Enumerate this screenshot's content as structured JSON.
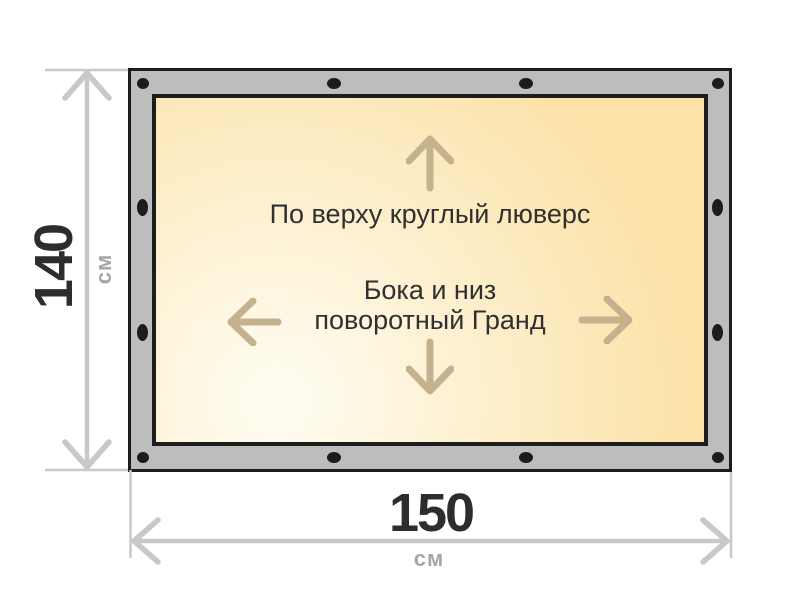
{
  "diagram": {
    "fabric": {
      "top_note": "По верху круглый люверс",
      "middle_note_line1": "Бока и низ",
      "middle_note_line2": "поворотный Гранд"
    },
    "height_dim": {
      "value": "140",
      "unit": "см"
    },
    "width_dim": {
      "value": "150",
      "unit": "см"
    },
    "grommets": {
      "top_count": 4,
      "bottom_count": 4,
      "left_middle_count": 2,
      "right_middle_count": 2
    }
  },
  "colors": {
    "frame": "#bdbdbd",
    "outline": "#1d1d1b",
    "fabric_light": "#fffdf3",
    "fabric_mid": "#fdf0cf",
    "fabric_peach": "#fce2a9",
    "arrow": "#c3b28d",
    "dimension_line": "#c8c8c8",
    "dimension_value": "#2d2d2d",
    "dimension_unit": "#a6a6a6",
    "note_text": "#303030",
    "grommet": "#1c1c1c"
  }
}
